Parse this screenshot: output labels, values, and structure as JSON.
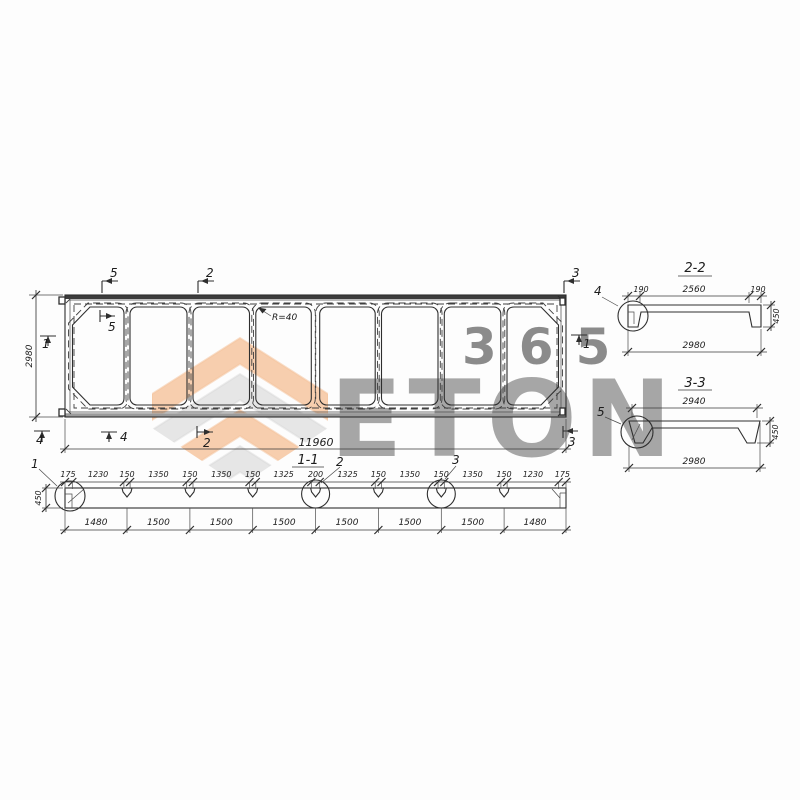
{
  "watermark": {
    "brand": "ETON",
    "badge": "365",
    "orange": "#f0944e",
    "gray": "#bfbfbf"
  },
  "plan": {
    "dim_width": "11960",
    "dim_height": "2980",
    "radius_note": "R=40",
    "markers": {
      "top_5": "5",
      "top_2": "2",
      "top_3": "3",
      "inner_5": "5",
      "left_1": "1",
      "left_4": "4",
      "bottom_4": "4",
      "bottom_2": "2",
      "bottom_3": "3",
      "right_1": "1"
    }
  },
  "section_1_1": {
    "title": "1-1",
    "dim_height": "450",
    "details": {
      "d1": "1",
      "d2": "2",
      "d3": "3"
    },
    "top_dims": [
      "175",
      "1230",
      "150",
      "1350",
      "150",
      "1350",
      "150",
      "1325",
      "200",
      "1325",
      "150",
      "1350",
      "150",
      "1350",
      "150",
      "1230",
      "175"
    ],
    "bottom_dims": [
      "1480",
      "1500",
      "1500",
      "1500",
      "1500",
      "1500",
      "1500",
      "1480"
    ]
  },
  "section_2_2": {
    "title": "2-2",
    "detail": "4",
    "dim_left": "190",
    "dim_mid": "2560",
    "dim_right": "190",
    "dim_height": "450",
    "dim_bottom": "2980"
  },
  "section_3_3": {
    "title": "3-3",
    "detail": "5",
    "dim_top": "2940",
    "dim_height": "450",
    "dim_bottom": "2980"
  }
}
